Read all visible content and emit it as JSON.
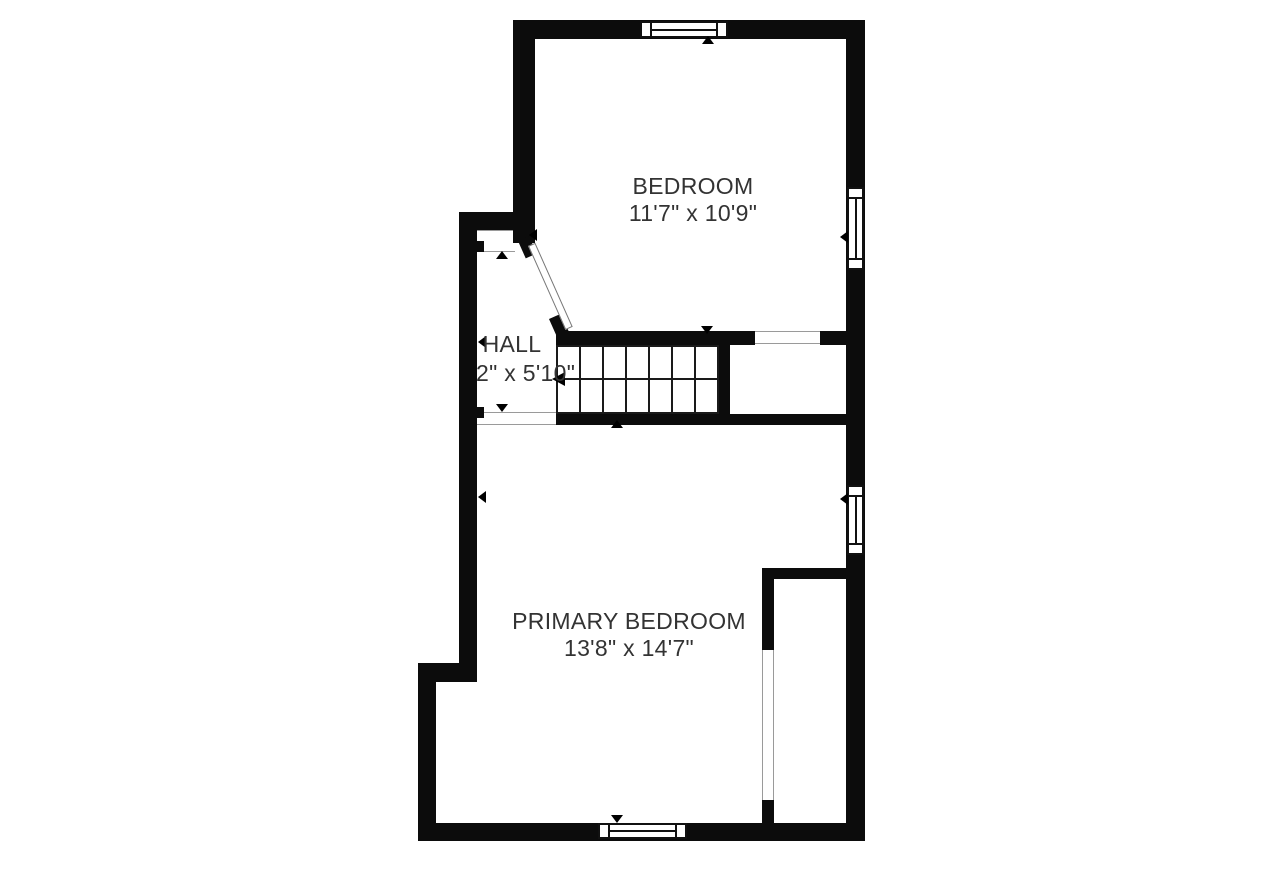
{
  "rooms": [
    {
      "label": "BEDROOM",
      "dimensions": "11'7\" x 10'9\""
    },
    {
      "label": "HALL",
      "dimensions": "2\" x 5'10\""
    },
    {
      "label": "PRIMARY BEDROOM",
      "dimensions": "13'8\" x 14'7\""
    }
  ],
  "colors": {
    "wall": "#0c0c0c",
    "background": "#ffffff",
    "text": "#333333",
    "opening_line": "#9a9a9a"
  }
}
